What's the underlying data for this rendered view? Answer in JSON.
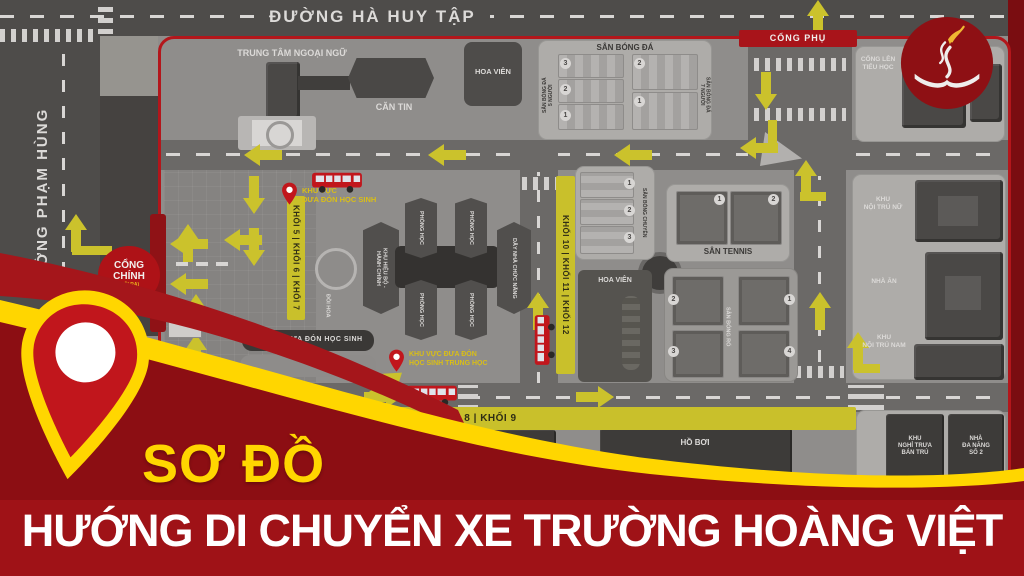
{
  "streets": {
    "top": "ĐƯỜNG HÀ HUY TẬP",
    "left": "ĐƯỜNG PHẠM HÙNG"
  },
  "gates": {
    "main_line1": "CỔNG",
    "main_line2": "CHÍNH",
    "main_sub": "(LỐI RA)",
    "secondary": "CỔNG PHỤ",
    "primary_school": "CỔNG LÊN\nTIỂU HỌC"
  },
  "top_area": {
    "language_center": "TRUNG TÂM NGOẠI NGỮ",
    "canteen": "CĂN TIN",
    "flower_garden": "HOA VIÊN"
  },
  "soccer": {
    "title": "SÂN BÓNG ĐÁ",
    "label5": "SÂN BÓNG ĐÁ\n5 NGƯỜI",
    "label7": "SÂN BÓNG ĐÁ\n7 NGƯỜI",
    "nums5": [
      "3",
      "2",
      "1"
    ],
    "nums7": [
      "2",
      "1"
    ]
  },
  "volleyball": {
    "title": "SÂN BÓNG CHUYỀN",
    "nums": [
      "1",
      "2",
      "3"
    ]
  },
  "tennis": {
    "title": "SÂN TENNIS",
    "nums": [
      "1",
      "2"
    ]
  },
  "basketball": {
    "title": "SÂN BÓNG RỔ",
    "nums": [
      "2",
      "1",
      "3",
      "4"
    ]
  },
  "mid": {
    "admin": "KHU HIỆU BỘ -\nHÀNH CHÍNH",
    "classroom": "PHÒNG HỌC",
    "function_row": "DÃY NHÀ CHỨC NĂNG",
    "flower_hill": "ĐỒI HOA",
    "flower_garden": "HOA VIÊN"
  },
  "banners": {
    "khoi567": "KHỐI 5  |  KHỐI 6  |  KHỐI 7",
    "khoi101112": "KHỐI 10  |  KHỐI 11  |  KHỐI 12",
    "khoi89": "KHỐI 8   |   KHỐI 9"
  },
  "pickup": {
    "area1": "KHU VỰC\nĐƯA ĐÓN HỌC SINH",
    "area2": "KHU VỰC ĐƯA ĐÓN\nHỌC SINH TRUNG HỌC",
    "bus_house": "NHÀ XE ĐƯA ĐÓN HỌC SINH",
    "guard": "PHÒNG\nBẢO VỆ"
  },
  "right_area": {
    "girls_dorm": "KHU\nNỘI TRÚ NỮ",
    "dining": "NHÀ ĂN",
    "boys_dorm": "KHU\nNỘI TRÚ NAM",
    "nap_area": "KHU\nNGHỈ TRƯA\nBÁN TRÚ",
    "multi2": "NHÀ\nĐA NĂNG\nSỐ 2"
  },
  "bottom_area": {
    "multi1": "NHÀ ĐA NĂNG SỐ 1",
    "pool": "HỒ BƠI"
  },
  "footer": {
    "title": "SƠ ĐỒ",
    "subtitle": "HƯỚNG DI CHUYỂN XE TRƯỜNG HOÀNG VIỆT"
  },
  "colors": {
    "accent_red": "#b01318",
    "accent_yellow": "#ffd600",
    "arrow_olive": "#cbc22c",
    "footer_maroon": "#8c0e13"
  }
}
